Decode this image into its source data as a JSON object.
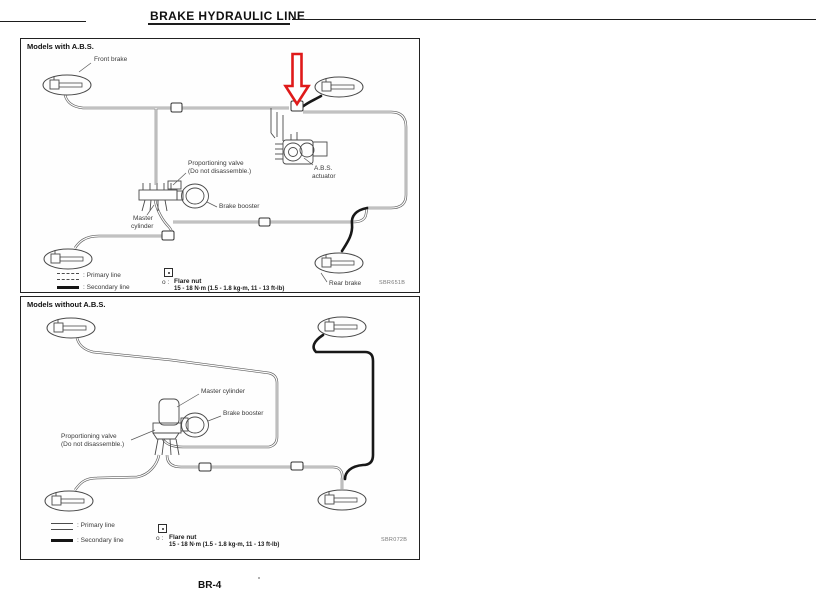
{
  "page": {
    "title": "BRAKE HYDRAULIC LINE",
    "page_number": "BR-4"
  },
  "abs_diagram": {
    "header": "Models with A.B.S.",
    "figure_code": "SBR651B",
    "labels": {
      "front_brake": "Front brake",
      "prop_valve_l1": "Proportioning valve",
      "prop_valve_l2": "(Do not disassemble.)",
      "master_l1": "Master",
      "master_l2": "cylinder",
      "brake_booster": "Brake booster",
      "abs_l1": "A.B.S.",
      "abs_l2": "actuator",
      "rear_brake": "Rear brake"
    },
    "legend": {
      "primary": ": Primary line",
      "secondary": ": Secondary line"
    },
    "flare_nut": {
      "prefix": "o :",
      "label": "Flare nut",
      "torque": "15 - 18 N·m (1.5 - 1.8 kg-m, 11 - 13 ft-lb)"
    }
  },
  "no_abs_diagram": {
    "header": "Models without A.B.S.",
    "figure_code": "SBR072B",
    "labels": {
      "master_cylinder": "Master cylinder",
      "brake_booster": "Brake booster",
      "prop_valve_l1": "Proportioning valve",
      "prop_valve_l2": "(Do not disassemble.)"
    },
    "legend": {
      "primary": ": Primary line",
      "secondary": ": Secondary line"
    },
    "flare_nut": {
      "prefix": "o :",
      "label": "Flare nut",
      "torque": "15 - 18 N·m (1.5 - 1.8 kg-m, 11 - 13 ft-lb)"
    }
  }
}
